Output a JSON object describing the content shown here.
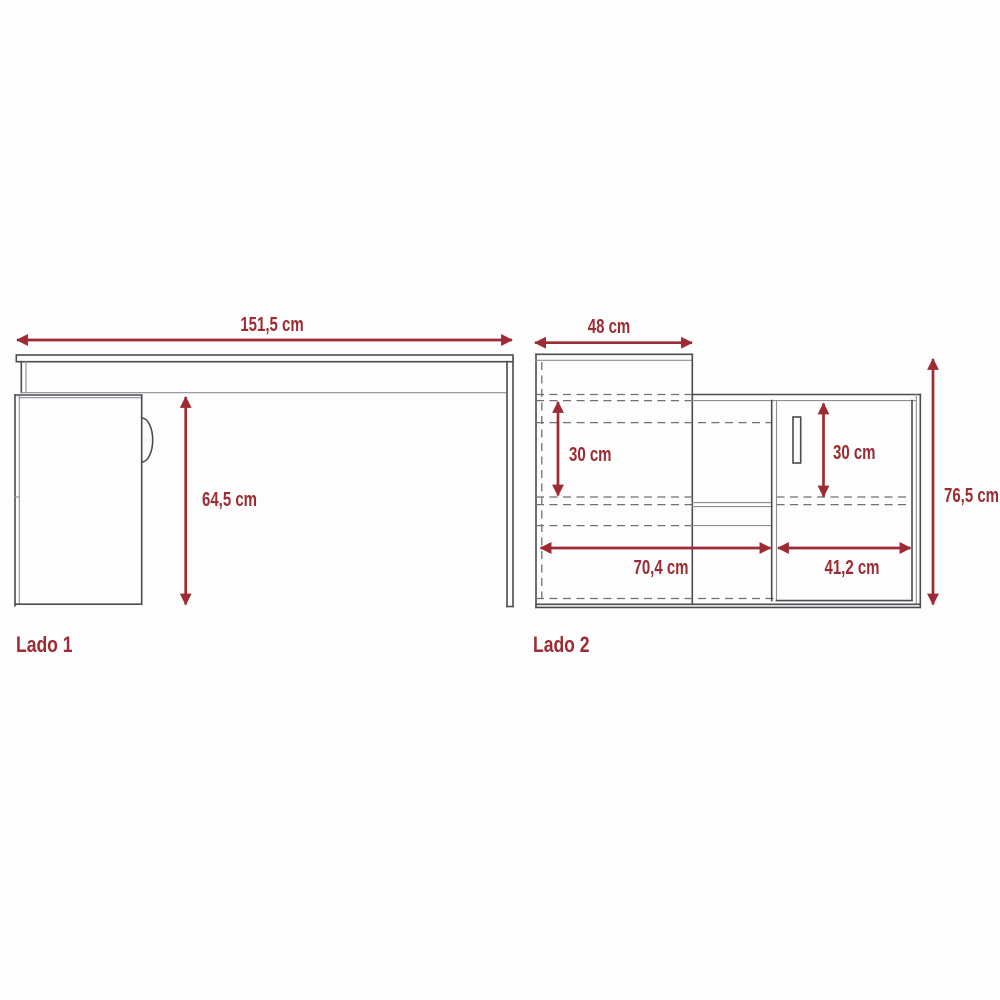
{
  "diagram": {
    "type": "furniture-dimension-drawing",
    "colors": {
      "dimension_red": "#9c2b33",
      "structure_dark": "#4b4b50",
      "structure_light": "#8e8e94",
      "hidden_dashed": "#6f6f75",
      "background": "#fdfdfd"
    },
    "lado1": {
      "label": "Lado 1",
      "dims": {
        "total_width": "151,5 cm",
        "under_top_height": "64,5 cm"
      }
    },
    "lado2": {
      "label": "Lado 2",
      "dims": {
        "top_depth": "48 cm",
        "hutch_opening_height": "30 cm",
        "door_opening_height": "30 cm",
        "left_section_width": "70,4 cm",
        "door_section_width": "41,2 cm",
        "total_height": "76,5 cm"
      }
    }
  }
}
